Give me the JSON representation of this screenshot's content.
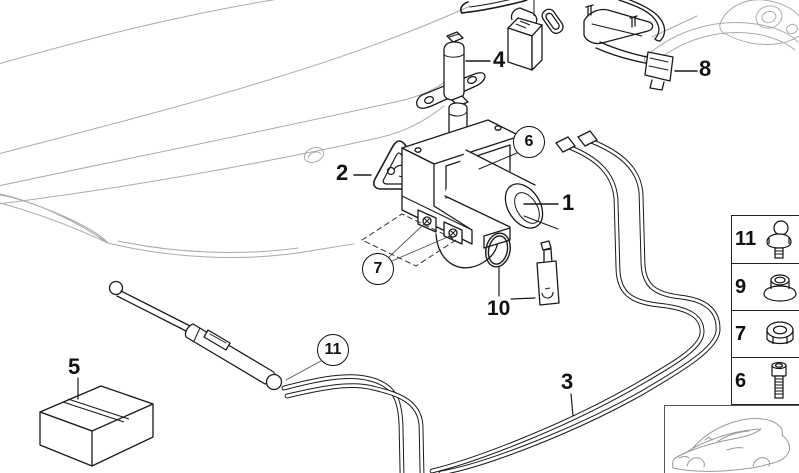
{
  "diagram": {
    "colors": {
      "part_line": "#1a1a1a",
      "context_line": "#ababab"
    },
    "callouts": {
      "c1": "1",
      "c2": "2",
      "c3": "3",
      "c4": "4",
      "c5": "5",
      "c6": "6",
      "c7": "7",
      "c8": "8",
      "c10": "10",
      "c11": "11"
    },
    "legend": {
      "items": [
        {
          "num": "11",
          "icon": "ball-pin-icon"
        },
        {
          "num": "9",
          "icon": "flange-nut-icon"
        },
        {
          "num": "7",
          "icon": "hex-nut-icon"
        },
        {
          "num": "6",
          "icon": "socket-head-bolt-icon"
        }
      ]
    },
    "vehicle_thumbnail": "car-outline-icon"
  }
}
